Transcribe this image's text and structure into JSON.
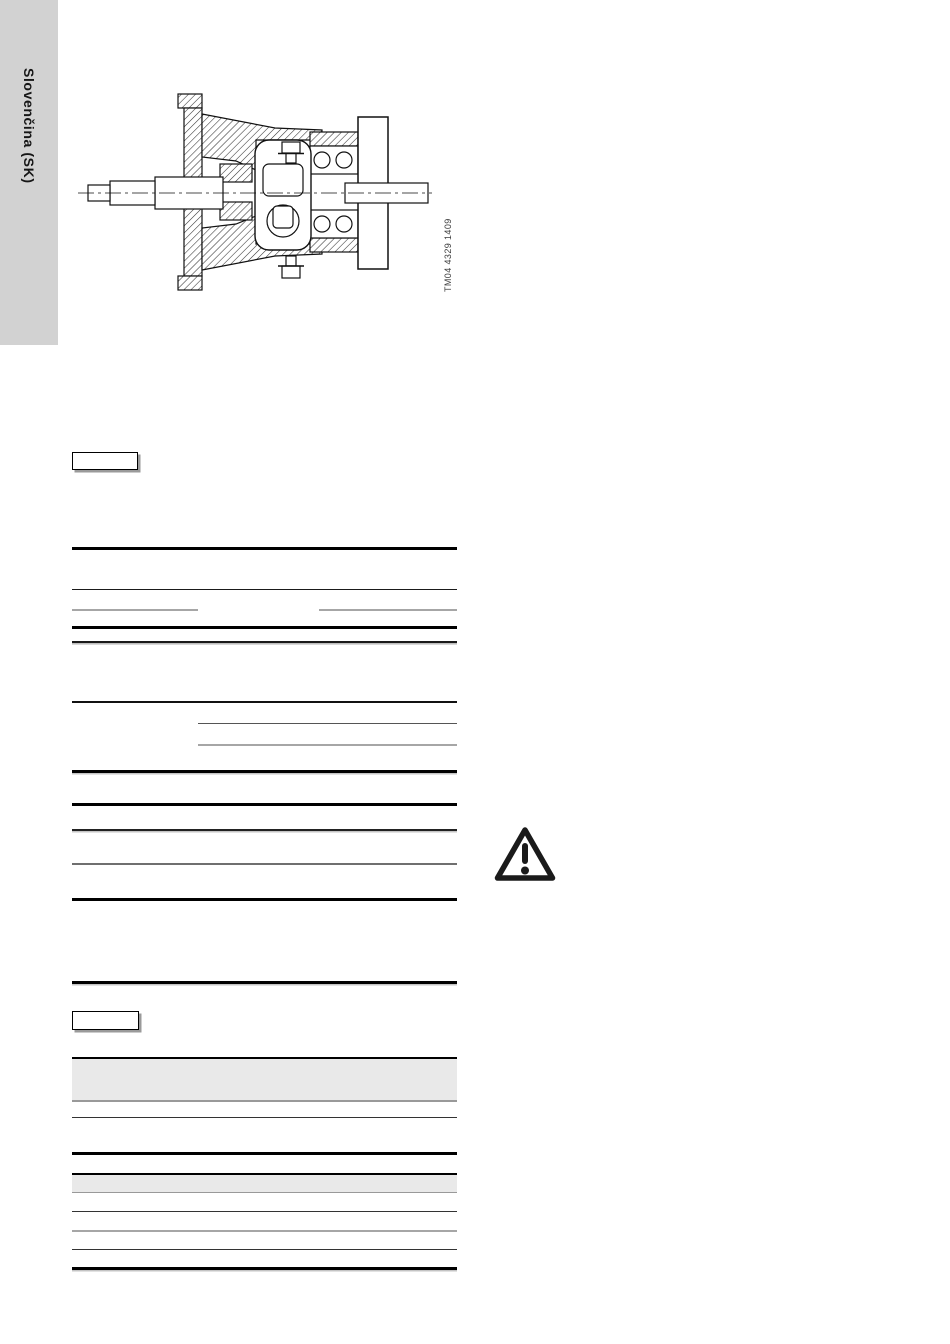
{
  "page": {
    "language_tab": {
      "label": "Slovenčina (SK)"
    },
    "figure": {
      "code": "TM04 4329 1409",
      "description": "Sectional drawing of a pump shaft with bearing bracket, flange and shaft seal"
    },
    "icons": {
      "warning": "warning-triangle-icon"
    },
    "colors": {
      "tab_bg": "#d2d2d2",
      "table_header_fill": "#e9e9e9",
      "rule_black": "#000000",
      "rule_dark": "#333333",
      "rule_gray": "#a6a6a6",
      "line_art": "#111111"
    }
  }
}
